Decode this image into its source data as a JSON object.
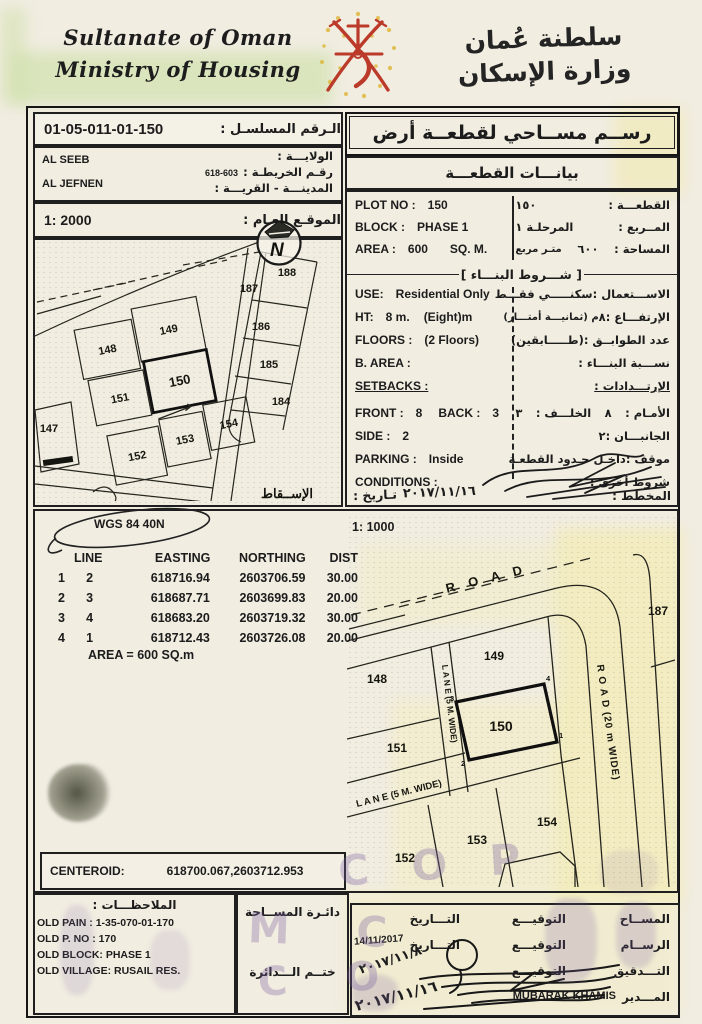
{
  "header": {
    "ministry_en_line1": "Sultanate of Oman",
    "ministry_en_line2": "Ministry of Housing",
    "ministry_ar_line1": "سلطنة عُمان",
    "ministry_ar_line2": "وزارة الإسكان"
  },
  "serial": {
    "label_ar": "الـرقم المسلسـل :",
    "value": "01-05-011-01-150"
  },
  "map_ref": {
    "wilayat_label_ar": "الولايـــة :",
    "map_no_label_ar": "رقـم الخريطـة :",
    "map_no": "618-603",
    "city_label_ar": "المدينـــة - القريـــة :",
    "wilayat_en": "AL SEEB",
    "village_en": "AL JEFNEN"
  },
  "general_site": {
    "scale": "1: 2000",
    "label_ar": "الموقـع العـام :"
  },
  "site_plan": {
    "north_letter": "N",
    "projection_ar": "الإســقاط",
    "plots": {
      "147": "147",
      "148": "148",
      "149": "149",
      "150": "150",
      "151": "151",
      "152": "152",
      "153": "153",
      "154": "154",
      "184": "184",
      "185": "185",
      "186": "186",
      "187": "187",
      "188": "188"
    }
  },
  "panel": {
    "title_ar": "رســم مســاحي لقطعــة أرض",
    "subtitle_ar": "بيانـــات القطعـــة"
  },
  "plot_info": {
    "plot_no_label": "PLOT NO :",
    "plot_no": "150",
    "plot_no_ar": "١٥٠",
    "plot_no_label_ar": "القطعـــة :",
    "block_label": "BLOCK :",
    "block": "PHASE 1",
    "block_ar": "المرحلـة ١",
    "block_label_ar": "المــربع :",
    "area_label": "AREA :",
    "area": "600",
    "area_unit": "SQ. M.",
    "area_ar": "٦٠٠",
    "area_unit_ar": "متـر مربع",
    "area_label_ar": "المساحة :"
  },
  "building": {
    "header_ar": "شـــروط البنـــاء",
    "use_label": "USE:",
    "use": "Residential Only",
    "use_label_ar": "الاســـتعمال :",
    "use_ar": "سكنـــــي فقـــط",
    "ht_label": "HT:",
    "ht": "8 m.",
    "ht_note": "(Eight)m",
    "ht_label_ar": "الإرتفـــاع :",
    "ht_ar": "٨",
    "ht_note_ar": "م  (ثمانيـــة أمتـــار)",
    "floors_label": "FLOORS :",
    "floors": "(2 Floors)",
    "floors_label_ar": "عدد الطوابــق :",
    "floors_ar": "(طـــــابقين)",
    "barea_label": "B. AREA :",
    "barea_label_ar": "نســـبة البنـــاء :",
    "setbacks_label": "SETBACKS :",
    "setbacks_label_ar": "الإرتـــدادات :",
    "front_label": "FRONT :",
    "front": "8",
    "back_label": "BACK :",
    "back": "3",
    "front_label_ar": "الأمـام :",
    "front_ar": "٨",
    "back_label_ar": "الخلـــف :",
    "back_ar": "٣",
    "side_label": "SIDE :",
    "side": "2",
    "side_label_ar": "الجانبـــان :",
    "side_ar": "٢",
    "parking_label": "PARKING :",
    "parking": "Inside",
    "parking_label_ar": "موقف :",
    "parking_ar": "داخـل حـدود القطعـة",
    "conditions_label": "CONDITIONS :",
    "conditions_label_ar": "شروط أخرى :",
    "planner_label_ar": "المخطط :",
    "date_label_ar": "تـاريخ :",
    "date_value": "٢٠١٧/١١/١٦"
  },
  "survey": {
    "datum": "WGS 84  40N",
    "scale_detail": "1: 1000",
    "col_line": "LINE",
    "col_easting": "EASTING",
    "col_northing": "NORTHING",
    "col_dist": "DIST",
    "rows": [
      [
        "1",
        "2",
        "618716.94",
        "2603706.59",
        "30.00"
      ],
      [
        "2",
        "3",
        "618687.71",
        "2603699.83",
        "20.00"
      ],
      [
        "3",
        "4",
        "618683.20",
        "2603719.32",
        "30.00"
      ],
      [
        "4",
        "1",
        "618712.43",
        "2603726.08",
        "20.00"
      ]
    ],
    "area_line": "AREA = 600  SQ.m",
    "centeroid_label": "CENTEROID:",
    "centeroid": "618700.067,2603712.953"
  },
  "detail_map": {
    "road": "R O A D",
    "road_wide": "R O A D (20 m WIDE)",
    "lane_v": "L A N E (5 M. WIDE)",
    "lane_h": "L A N E (5 M. WIDE)",
    "plots": {
      "148": "148",
      "149": "149",
      "150": "150",
      "151": "151",
      "152": "152",
      "153": "153",
      "154": "154",
      "187": "187"
    },
    "c1": "1",
    "c2": "2",
    "c3": "3",
    "c4": "4"
  },
  "notes": {
    "header_ar": "الملاحظـــات :",
    "line1": "OLD PAIN : 1-35-070-01-170",
    "line2": "OLD P. NO : 170",
    "line3": "OLD BLOCK: PHASE 1",
    "line4": "OLD VILLAGE: RUSAIL RES."
  },
  "stamp": {
    "dept_ar": "دائـرة المســاحة",
    "seal_ar": "ختــم الـــدائرة"
  },
  "signatures": {
    "surveyor_ar": "المســاح",
    "draftsman_ar": "الرســام",
    "checking_ar": "التـــدقيق",
    "director_ar": "المـــدير",
    "sig_ar": "التوقيـــع",
    "date_ar": "التـــاريخ",
    "draft_date": "14/11/2017",
    "check_date_hw": "٢٠١٧/١١/٨",
    "director_date_hw": "٢٠١٧/١١/١٦",
    "director_name": "MUBARAK KHAMIS"
  },
  "stamp_fragments": {
    "f1": "C O P",
    "f2": "M C",
    "f3": "C O"
  },
  "colors": {
    "ink": "#1c1c1c",
    "emblem_red": "#bb3a2a",
    "emblem_gold": "#dfb93e",
    "stamp_purple": "#8062a4"
  }
}
